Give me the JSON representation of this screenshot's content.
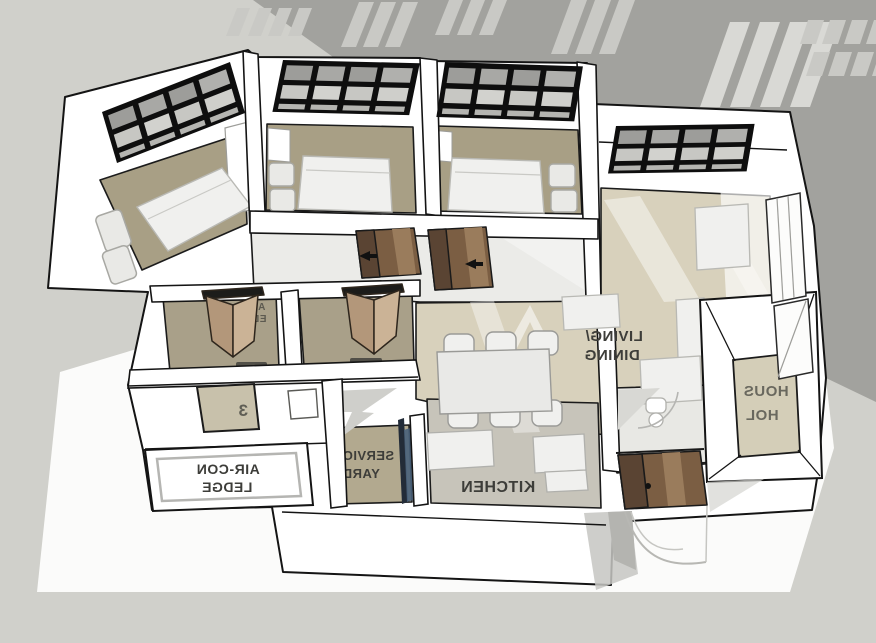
{
  "scene": {
    "description": "3D isometric floor-plan render, horizontally mirrored text",
    "labels": {
      "living_dining": {
        "line1": "LIVING/",
        "line2": "DINING"
      },
      "kitchen": "KITCHEN",
      "service_yard": {
        "line1": "SERVICE",
        "line2": "YARD"
      },
      "aircon_ledge": {
        "line1": "AIR-CON",
        "line2": "LEDGE"
      },
      "household_shelter": {
        "line1": "HOUS",
        "line2": "HOL"
      },
      "bath_partial": {
        "line1": "AIR",
        "line2": "ED"
      },
      "wall_panel_digit": "3"
    },
    "colors": {
      "bg": "#d0d0cb",
      "shadow": "#a2a29e",
      "stripe": "#c9c9c5",
      "stripe_bright": "#d9d9d5",
      "ground": "#fbfbfa",
      "wall": "#ffffff",
      "line": "#141414",
      "floor_bedroom": "#a89f85",
      "floor_living": "#d8d1bc",
      "floor_kitchen": "#c7c4ba",
      "floor_service": "#b2a98f",
      "floor_bath": "#a9a089",
      "floor_shelter": "#d4ceb8",
      "floor_corridor": "#ebebe8",
      "floor_wc": "#e8e8e4",
      "door_dark": "#5a4433",
      "door_mid": "#7b5e43",
      "door_light": "#9a7c5c",
      "bifold_light": "#cbb396",
      "bifold_dark": "#b3977a",
      "glass_dark": "#9d9d9a",
      "glass_light": "#c7c7c3",
      "glass_sill": "#b5b5b1",
      "window_frame": "#0e0e0e",
      "furniture": "#f0f0ee",
      "label_text": "#3d3d39",
      "yard_glass": "#232c38",
      "yard_glass_hi": "#48607a"
    }
  }
}
